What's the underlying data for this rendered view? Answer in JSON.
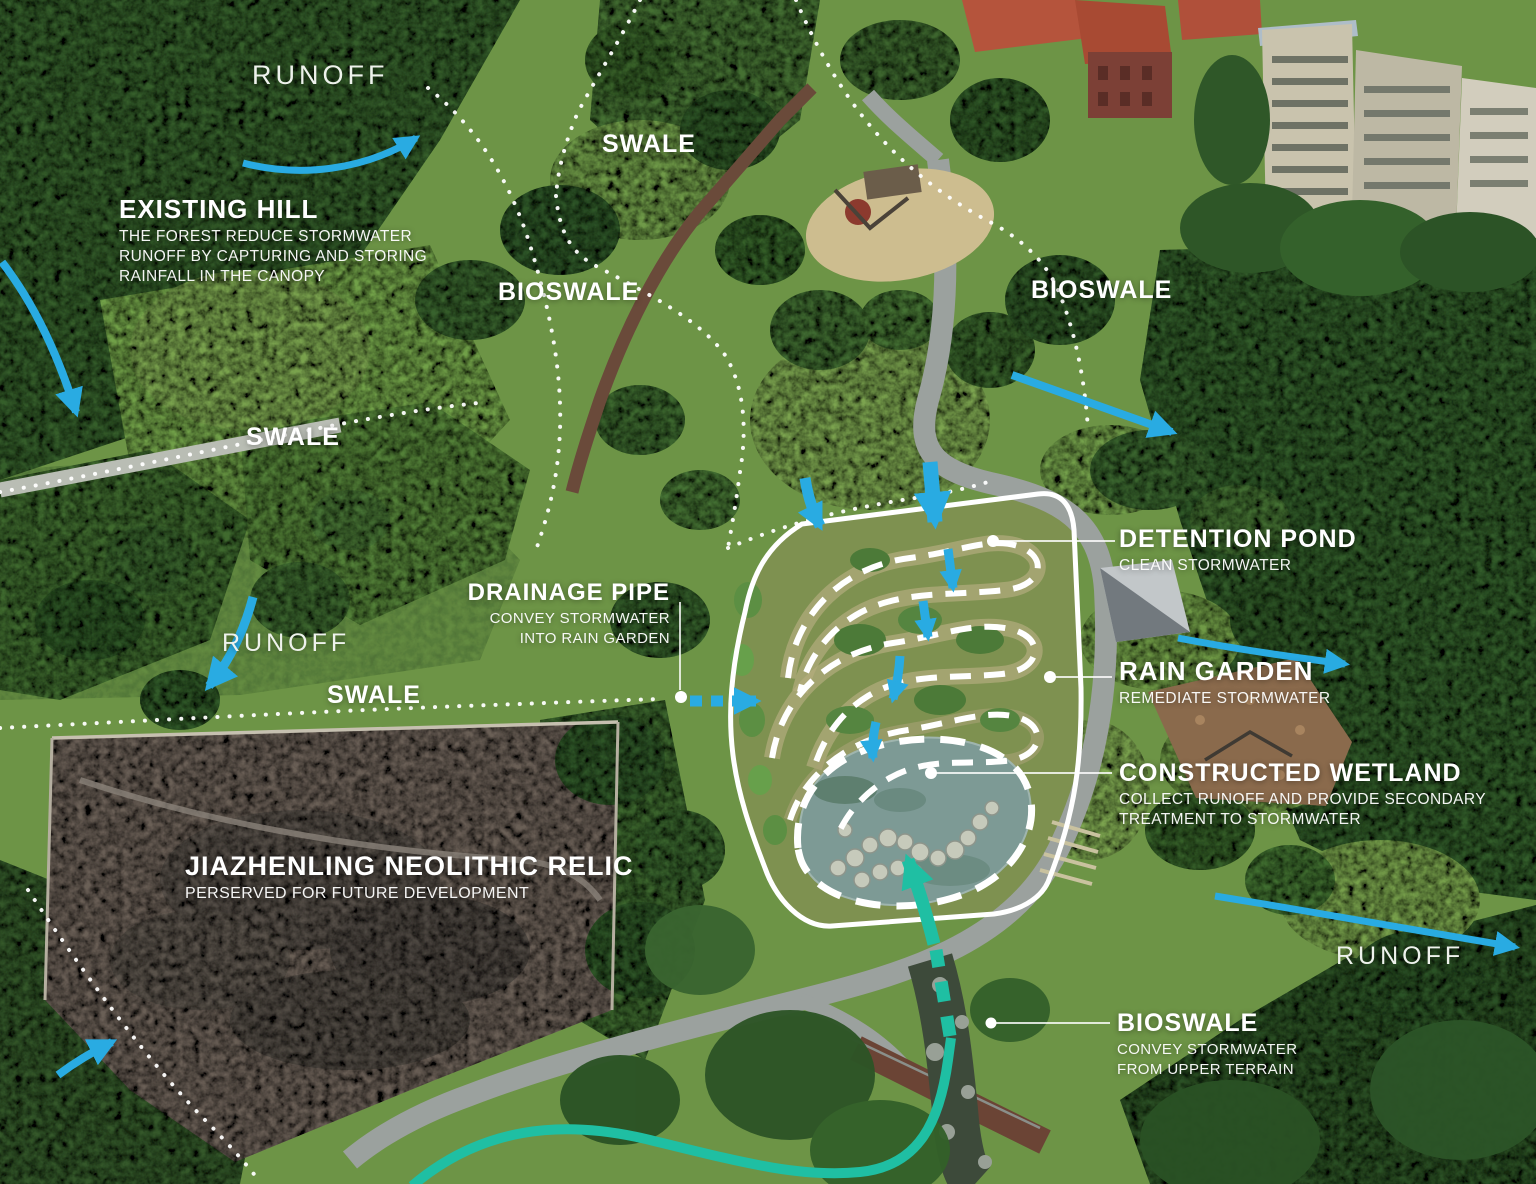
{
  "colors": {
    "arrow_blue": "#29abe2",
    "arrow_teal": "#1fbfa3",
    "annotation_white": "#ffffff"
  },
  "labels": {
    "runoff_top_left": {
      "text": "RUNOFF"
    },
    "swale_top": {
      "text": "SWALE"
    },
    "existing_hill": {
      "title": "EXISTING HILL",
      "line1": "THE FOREST REDUCE STORMWATER",
      "line2": "RUNOFF BY CAPTURING AND STORING",
      "line3": "RAINFALL IN THE CANOPY"
    },
    "bioswale_left": {
      "text": "BIOSWALE"
    },
    "bioswale_right": {
      "text": "BIOSWALE"
    },
    "swale_mid": {
      "text": "SWALE"
    },
    "drainage_pipe": {
      "title": "DRAINAGE PIPE",
      "line1": "CONVEY STORMWATER",
      "line2": "INTO RAIN GARDEN"
    },
    "runoff_mid_left": {
      "text": "RUNOFF"
    },
    "swale_lower": {
      "text": "SWALE"
    },
    "detention_pond": {
      "title": "DETENTION POND",
      "subtitle": "CLEAN STORMWATER"
    },
    "rain_garden": {
      "title": "RAIN GARDEN",
      "subtitle": "REMEDIATE STORMWATER"
    },
    "constructed_wetland": {
      "title": "CONSTRUCTED WETLAND",
      "line1": "COLLECT RUNOFF AND PROVIDE SECONDARY",
      "line2": "TREATMENT TO STORMWATER"
    },
    "jiazhenling_relic": {
      "title": "JIAZHENLING NEOLITHIC RELIC",
      "subtitle": "PERSERVED FOR FUTURE DEVELOPMENT"
    },
    "runoff_bottom_right": {
      "text": "RUNOFF"
    },
    "bioswale_bottom": {
      "title": "BIOSWALE",
      "line1": "CONVEY STORMWATER",
      "line2": "FROM UPPER TERRAIN"
    }
  }
}
